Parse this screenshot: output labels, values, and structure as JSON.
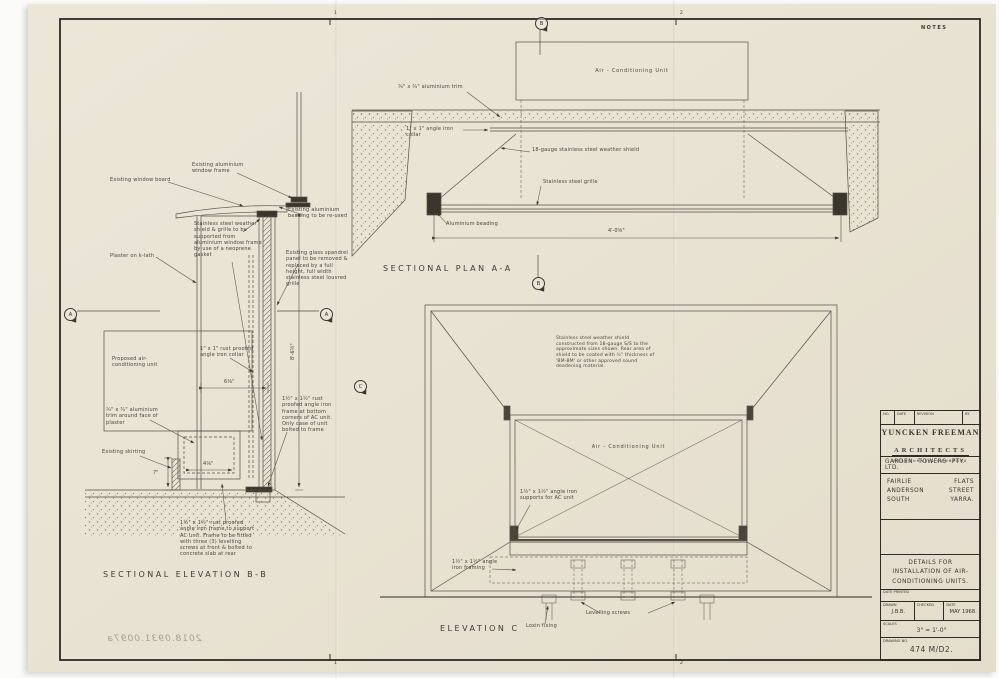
{
  "sheet": {
    "notes": "NOTES",
    "stamp": "2018.0931.0097a",
    "ticks": {
      "t1": "1",
      "t2": "2",
      "b1": "1",
      "b2": "2"
    }
  },
  "markers": {
    "a_left": "A",
    "a_right": "A",
    "c": "C",
    "b_top": "B",
    "b_mid": "B"
  },
  "elev_bb": {
    "title": "SECTIONAL ELEVATION B-B",
    "labels": {
      "window_board": "Existing window board",
      "window_frame": "Existing aluminium window frame",
      "weather_shield": "Stainless steel weather shield & grille to be supported from aluminium window frame by use of a neoprene gasket",
      "plaster": "Plaster on k-lath",
      "beading": "Existing aluminium beading to be re-used",
      "spandrel": "Existing glass spandrel panel to be removed & replaced by a full height, full width stainless steel louvred grille",
      "unit": "Proposed air-conditioning unit",
      "collar": "1\" x 1\" rust proofed angle iron collar",
      "trim": "¾\" x ¾\" aluminium trim around face of plaster",
      "skirting": "Existing skirting",
      "corner_angle": "1½\" x 1½\" rust proofed angle iron frame at bottom corners of AC unit. Only case of unit bolted to frame",
      "support_frame": "1½\" x 1½\" rust proofed angle iron frame to support AC unit. Frame to be fitted with three (3) levelling screws at front & bolted to concrete slab at rear"
    },
    "dims": {
      "collar_w": "6⅛\"",
      "height": "8'-6⅝\"",
      "plinth": "4⅛\"",
      "skirt": "7\""
    }
  },
  "plan_aa": {
    "title": "SECTIONAL PLAN A-A",
    "labels": {
      "unit": "Air - Conditioning Unit",
      "trim": "¾\" x ¾\" aluminium trim",
      "collar": "1\" x 1\" angle iron collar",
      "shield": "18-gauge stainless steel weather shield",
      "grille": "Stainless steel grille",
      "beading": "Aluminium beading"
    },
    "dims": {
      "width": "4'-0⅝\""
    }
  },
  "elev_c": {
    "title": "ELEVATION C",
    "labels": {
      "note": "Stainless steel weather shield constructed from 18-gauge S/S to the approximate sizes shown. Rear area of shield to be coated with ½\" thickness of 'BM-BM' or other approved sound deadening material.",
      "unit": "Air - Conditioning Unit",
      "supports": "1½\" x 1½\" angle iron supports for AC unit",
      "framing": "1½\" x 1½\" angle iron framing",
      "levelling": "Levelling screws",
      "loxin": "Loxin fixing"
    }
  },
  "title_block": {
    "rev_headers": [
      "NO.",
      "DATE",
      "REVISION",
      "BY"
    ],
    "firm_line1": "YUNCKEN FREEMAN",
    "firm_line2": "ARCHITECTS",
    "firm_line3": "MELBOURNE & CANBERRA",
    "client": "GARDEN TOWERS PTY. LTD.",
    "project_l1a": "FAIRLIE",
    "project_l1b": "FLATS",
    "project_l2a": "ANDERSON",
    "project_l2b": "STREET",
    "project_l3a": "SOUTH",
    "project_l3b": "YARRA.",
    "drawing_title": "DETAILS FOR INSTALLATION OF AIR-CONDITIONING UNITS.",
    "date_printed_label": "DATE PRINTED",
    "drawn_label": "DRAWN",
    "drawn_value": "J.B.B.",
    "checked_label": "CHECKED",
    "date_label": "DATE",
    "date_value": "MAY 1968.",
    "scales_label": "SCALES",
    "scales_value": "3\" = 1'-0\"",
    "drawing_no_label": "DRAWING NO.",
    "drawing_no_value": "474 M/D2."
  }
}
